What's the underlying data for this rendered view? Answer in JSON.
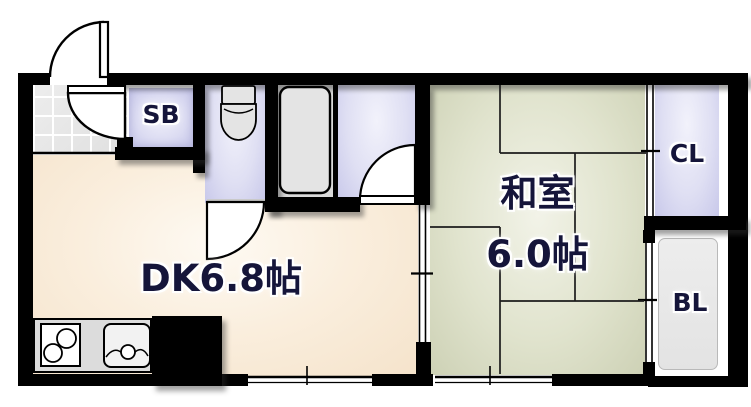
{
  "plan": {
    "type": "apartment-floor-plan",
    "labels": {
      "dk": "DK6.8帖",
      "washitsu_name": "和室",
      "washitsu_size": "6.0帖",
      "shoe_box": "SB",
      "closet": "CL",
      "balcony": "BL"
    },
    "colors": {
      "wall": "#000000",
      "dk_floor": "#f7e8d2",
      "washitsu_floor": "#d8dcc2",
      "wet_area_floor": "#cdcdee",
      "genkan_tile": "#e4e4e4",
      "fixture_fill": "#e4e4e4",
      "label_text": "#15153a"
    }
  }
}
